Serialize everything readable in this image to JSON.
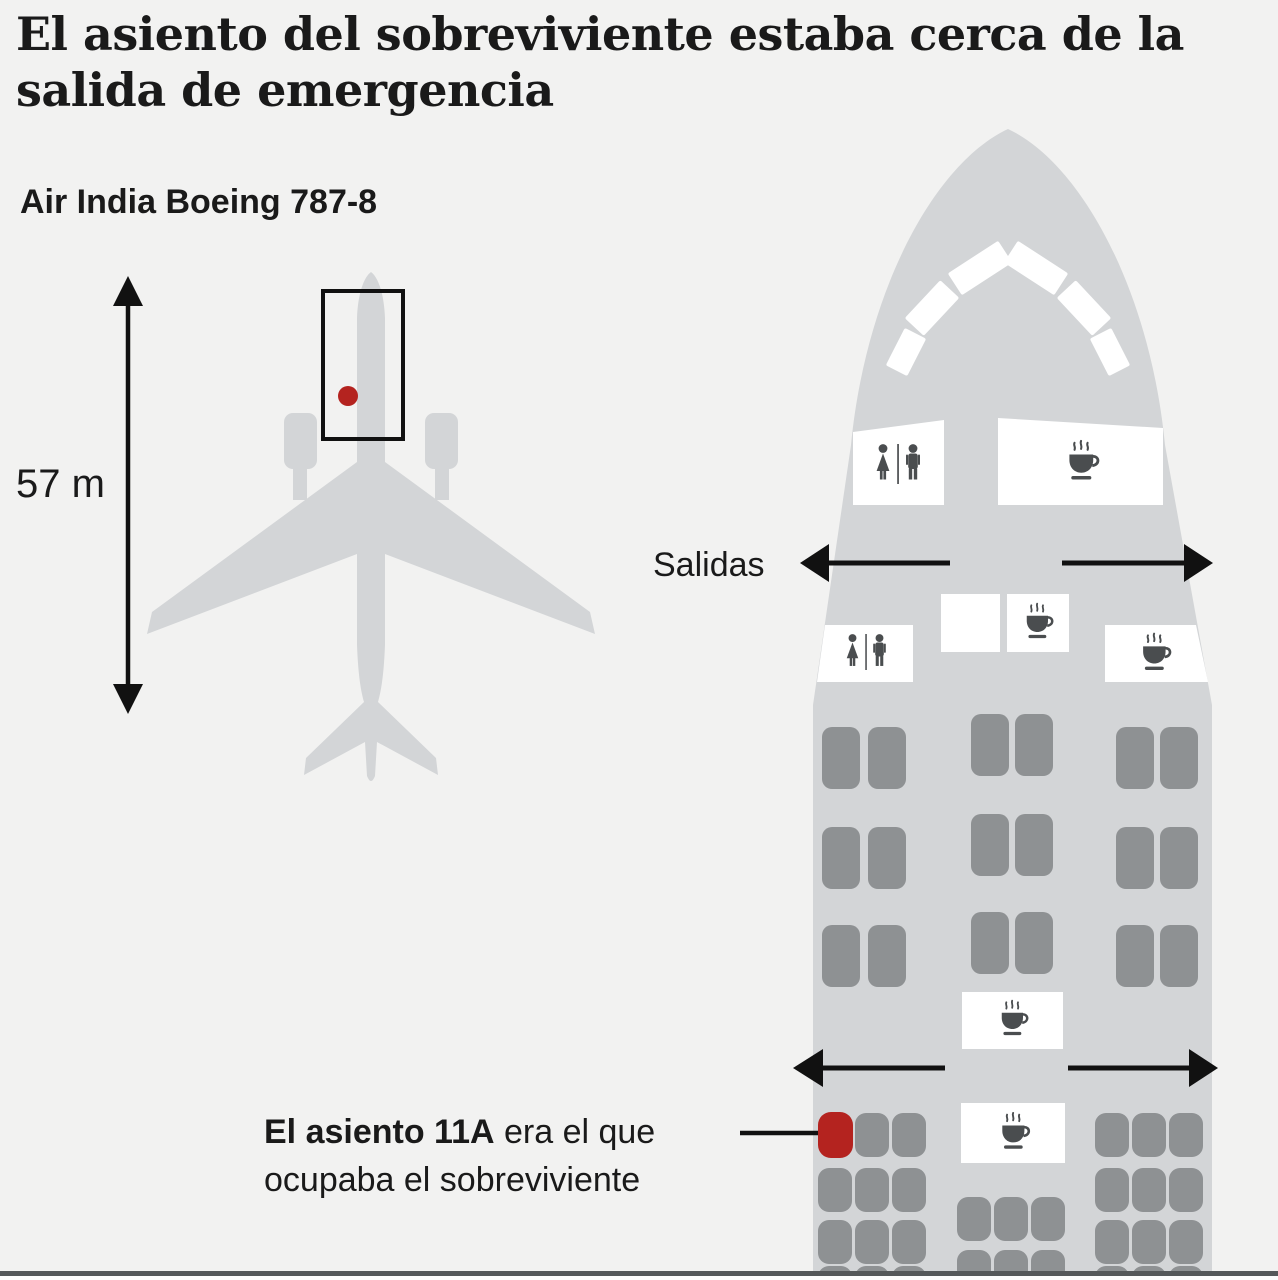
{
  "title": "El asiento del sobreviviente estaba cerca de la salida de emergencia",
  "aircraft": {
    "label": "Air India Boeing 787-8",
    "length_label": "57 m"
  },
  "seat_map": {
    "exits_label": "Salidas",
    "note_bold": "El asiento 11A",
    "note_after": " era el que",
    "note_line2": "ocupaba el sobreviviente",
    "highlighted_seat": "11A",
    "cabin_layout": {
      "business_rows": 3,
      "business_config": "2-2-2",
      "economy_config": "3-3-3"
    }
  },
  "icons": {
    "lavatory": "restroom-woman-man-icon",
    "galley": "coffee-cup-icon",
    "exits": "double-exit-arrows-icon",
    "length": "vertical-measure-arrow-icon",
    "cockpit": "cockpit-windows-icon"
  },
  "colors": {
    "background": "#f2f2f1",
    "fuselage": "#d3d5d7",
    "seat_gray": "#8e9193",
    "seat_red": "#b4231f",
    "icon_gray": "#4a4d4f",
    "text": "#1a1a1a",
    "line_black": "#111111",
    "bottom_bar": "#55585a"
  }
}
